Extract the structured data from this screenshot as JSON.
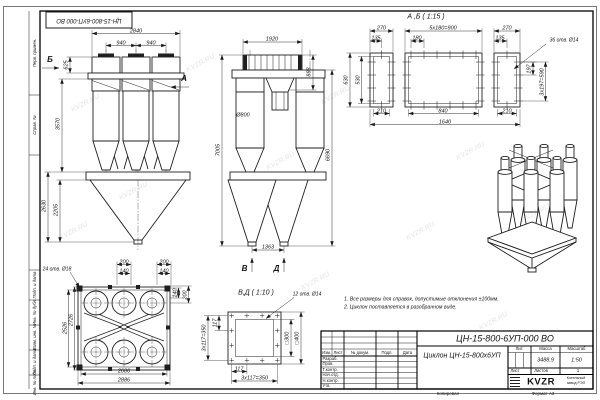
{
  "watermark": {
    "text": "KVZR.RU"
  },
  "stamp": {
    "doc_number_rotated": "ЦН-15-800-6УП-000 ВО"
  },
  "margin": {
    "labels": [
      "Перв. примен.",
      "Справ. №",
      "Подп. и дата",
      "Инв. № дубл.",
      "Взам. инв. №",
      "Подп. и дата",
      "Инв. № подл."
    ]
  },
  "front_view": {
    "label_b": "Б",
    "label_a": "А",
    "dim_total_width": "2840",
    "dim_pitch_1": "940",
    "dim_pitch_2": "940",
    "dim_inlet_height": "625",
    "dim_body_height": "3570",
    "dim_hopper_height": "2630",
    "dim_cone_height": "2205"
  },
  "side_view": {
    "dim_top_width": "1920",
    "dim_inlet": "888",
    "dia_body": "Ø800",
    "dim_total_height": "7005",
    "dim_height": "6690",
    "dim_outlet_pitch": "1363",
    "label_v": "В",
    "label_d": "Д"
  },
  "view_ab": {
    "title": "А ,Б ( 1:15 )",
    "dim_270_left": "270",
    "dim_135_left": "135",
    "dim_pitch_row": "5х180=900",
    "dim_180": "180",
    "dim_270_right": "270",
    "dim_135_right": "135",
    "holes_note": "36 отв. Ø14",
    "dim_197": "197",
    "dim_pitch_col": "3х197=590",
    "dim_630": "630",
    "dim_530": "530",
    "dim_210_left": "210",
    "dim_840": "840",
    "dim_210_right": "210",
    "dim_1640": "1640"
  },
  "top_view": {
    "holes_note": "24 отв. Ø18",
    "dim_200_a": "200",
    "dim_200_b": "200",
    "dim_140_a": "140",
    "dim_140_b": "140",
    "dim_140_right": "140",
    "dim_200_right": "200",
    "dim_2526": "2526",
    "dim_2726": "2726",
    "dim_2686": "2686",
    "dim_2886": "2886"
  },
  "view_vd": {
    "title": "В,Д ( 1:10 )",
    "holes_note": "12 отв. Ø14",
    "dim_pitch_left": "3х117=350",
    "dim_117_left": "117",
    "dim_square_300": "□300",
    "dim_square_400": "□400",
    "dim_117_bottom": "117",
    "dim_pitch_bottom": "3х117=350"
  },
  "notes": {
    "line1": "1. Все размеры для справок, допустимые отклонения ±100мм.",
    "line2": "2. Циклон поставляется в разобранном виде."
  },
  "title_block": {
    "doc_number": "ЦН-15-800-6УП-000 ВО",
    "product_name": "Циклон ЦН-15-800х6УП",
    "col_izm": "Изм.",
    "col_list": "Лист",
    "col_docnum": "№ докум.",
    "col_podp": "Подп.",
    "col_data": "Дата",
    "row_razrab": "Разраб.",
    "row_prov": "Пров.",
    "row_tkontr": "Т.контр.",
    "row_nachotd": "Нач.отд.",
    "row_nkontr": "Н.контр.",
    "row_utv": "Утв.",
    "lit_label": "Лит.",
    "mass_label": "Масса",
    "scale_label": "Масштаб",
    "mass_value": "3488,9",
    "scale_value": "1:50",
    "sheet_label": "Лист",
    "sheets_label": "Листов",
    "sheets_value": "1",
    "logo_text": "KVZR",
    "company_line1": "Котельный",
    "company_line2": "завод РЭП",
    "copied_label": "Копировал",
    "format_label": "Формат А3"
  }
}
